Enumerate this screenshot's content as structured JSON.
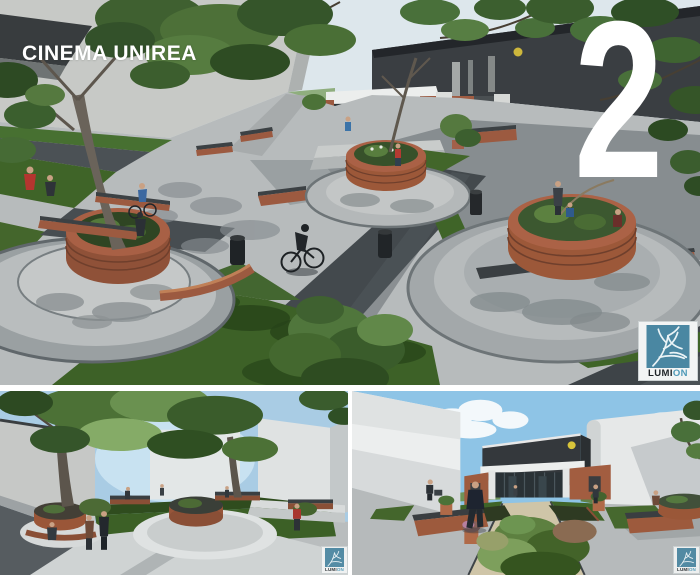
{
  "board": {
    "title": "CINEMA UNIREA",
    "page_number": "2",
    "watermark": {
      "prefix": "LUMI",
      "suffix": "ON"
    },
    "renders": {
      "main": {
        "label": "aerial plaza render with round brick planters"
      },
      "bottom_left": {
        "label": "street-level plaza render with trees"
      },
      "bottom_right": {
        "label": "render of cinema entrance walkway"
      }
    },
    "colors": {
      "lumion_teal": "#4a87a2",
      "title_white": "#ffffff",
      "brick": "#9c5a40",
      "lawn_green": "#3f6428",
      "asphalt": "#43494d",
      "concrete": "#b7bbbc",
      "facade_dark": "#3a3e42",
      "sky_blue": "#8ec4e6"
    }
  }
}
